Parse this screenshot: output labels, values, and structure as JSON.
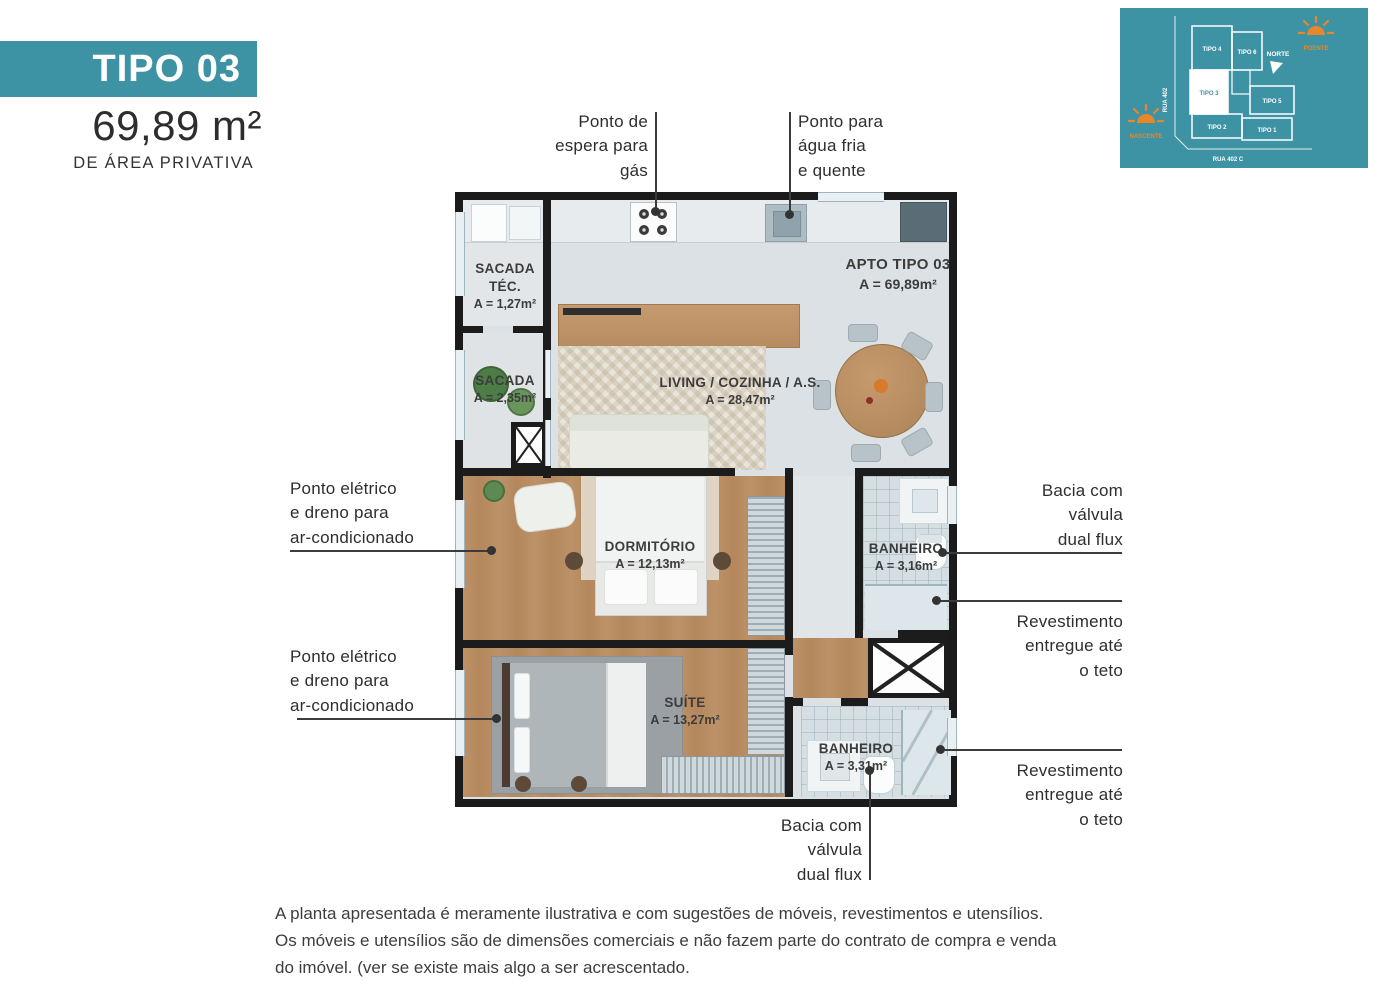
{
  "header": {
    "type_label": "TIPO 03",
    "area_value": "69,89 m²",
    "area_caption": "DE ÁREA PRIVATIVA"
  },
  "key_plan": {
    "background": "#3d93a3",
    "accent_orange": "#e8862c",
    "units": [
      {
        "label": "TIPO 4",
        "highlighted": false
      },
      {
        "label": "TIPO 6",
        "highlighted": false
      },
      {
        "label": "TIPO 3",
        "highlighted": true
      },
      {
        "label": "TIPO 5",
        "highlighted": false
      },
      {
        "label": "TIPO 2",
        "highlighted": false
      },
      {
        "label": "TIPO 1",
        "highlighted": false
      }
    ],
    "north_label": "NORTE",
    "sun_west_label": "POENTE",
    "sun_east_label": "NASCENTE",
    "street_left": "RUA 402",
    "street_bottom": "RUA 402 C"
  },
  "plan": {
    "apto": {
      "title": "APTO TIPO 03",
      "area": "A = 69,89m²"
    },
    "rooms": {
      "sacada_tec": {
        "name": "SACADA TÉC.",
        "area": "A = 1,27m²"
      },
      "sacada": {
        "name": "SACADA",
        "area": "A = 2,35m²"
      },
      "living": {
        "name": "LIVING / COZINHA / A.S.",
        "area": "A = 28,47m²"
      },
      "dormitorio": {
        "name": "DORMITÓRIO",
        "area": "A = 12,13m²"
      },
      "banheiro_1": {
        "name": "BANHEIRO",
        "area": "A = 3,16m²"
      },
      "suite": {
        "name": "SUÍTE",
        "area": "A = 13,27m²"
      },
      "banheiro_2": {
        "name": "BANHEIRO",
        "area": "A = 3,31m²"
      }
    }
  },
  "annotations": {
    "gas": {
      "lines": [
        "Ponto de",
        "espera para",
        "gás"
      ]
    },
    "water": {
      "lines": [
        "Ponto para",
        "água fria",
        "e quente"
      ]
    },
    "ac_top": {
      "lines": [
        "Ponto elétrico",
        "e dreno para",
        "ar-condicionado"
      ]
    },
    "ac_bottom": {
      "lines": [
        "Ponto elétrico",
        "e dreno para",
        "ar-condicionado"
      ]
    },
    "toilet_right": {
      "lines": [
        "Bacia com",
        "válvula",
        "dual flux"
      ]
    },
    "coating_top": {
      "lines": [
        "Revestimento",
        "entregue até",
        "o teto"
      ]
    },
    "coating_bottom": {
      "lines": [
        "Revestimento",
        "entregue até",
        "o teto"
      ]
    },
    "toilet_bottom": {
      "lines": [
        "Bacia com",
        "válvula",
        "dual flux"
      ]
    }
  },
  "disclaimer": {
    "lines": [
      "A planta apresentada é meramente ilustrativa e com sugestões de móveis, revestimentos e utensílios.",
      "Os móveis e utensílios são de dimensões comerciais e não fazem parte do contrato de compra e venda",
      "do imóvel. (ver se existe mais algo a ser acrescentado."
    ]
  }
}
